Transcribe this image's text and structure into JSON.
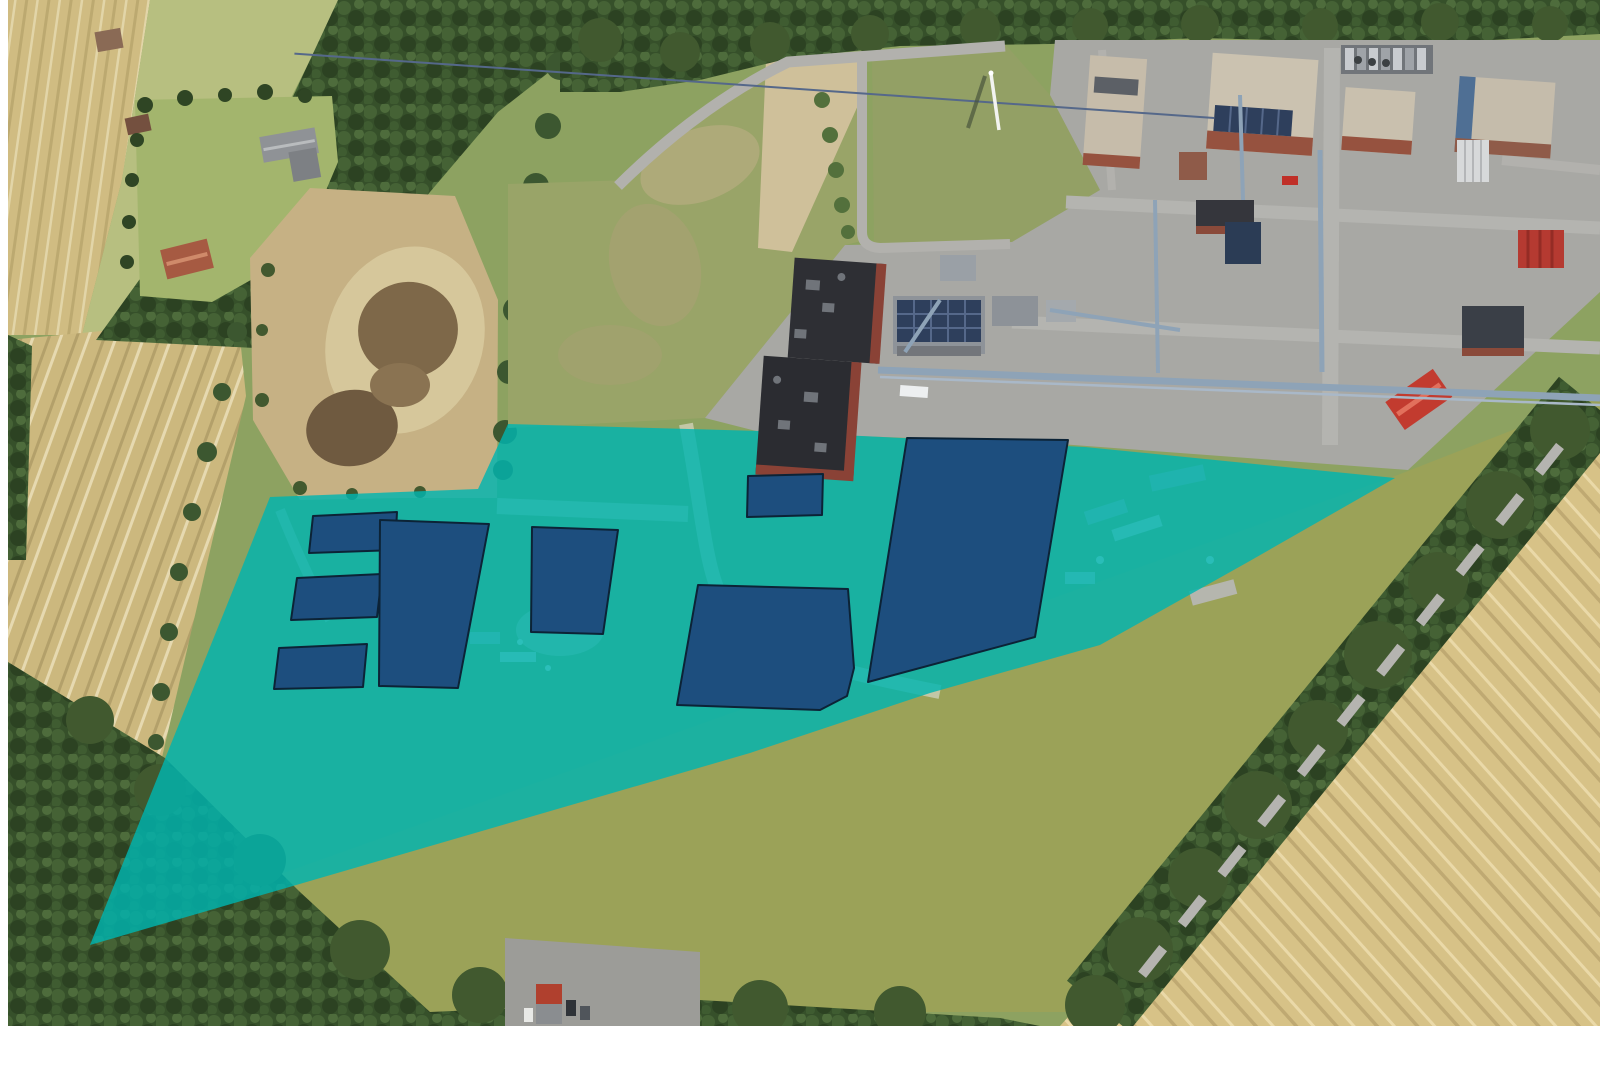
{
  "image": {
    "width": 1600,
    "height": 1066,
    "kind": "aerial-site-plan-overlay",
    "description": "Aerial photograph of a natural-gas processing plant with surrounding farmland; a teal polygon highlights the planned expansion site south-west of the plant and dark blue polygons mark planned building footprints. No text labels are visible."
  },
  "overlay": {
    "site_area": {
      "name": "highlighted-site-area",
      "fill": "#00b4b0",
      "opacity": 0.82,
      "points": [
        [
          270,
          497
        ],
        [
          478,
          489
        ],
        [
          508,
          424
        ],
        [
          760,
          431
        ],
        [
          1085,
          447
        ],
        [
          1395,
          478
        ],
        [
          1248,
          562
        ],
        [
          1100,
          645
        ],
        [
          930,
          693
        ],
        [
          750,
          753
        ],
        [
          90,
          945
        ],
        [
          233,
          590
        ]
      ]
    },
    "building_footprints": {
      "name": "planned-building-footprints",
      "fill": "#1d4e7e",
      "stroke": "#0c2336",
      "stroke_width": 2,
      "polygons": [
        {
          "id": "footprint-1",
          "points": [
            [
              313,
              516
            ],
            [
              397,
              512
            ],
            [
              395,
              550
            ],
            [
              309,
              553
            ]
          ]
        },
        {
          "id": "footprint-2",
          "points": [
            [
              297,
              578
            ],
            [
              382,
              574
            ],
            [
              377,
              617
            ],
            [
              291,
              620
            ]
          ]
        },
        {
          "id": "footprint-3",
          "points": [
            [
              279,
              648
            ],
            [
              367,
              644
            ],
            [
              363,
              687
            ],
            [
              274,
              689
            ]
          ]
        },
        {
          "id": "footprint-4",
          "points": [
            [
              380,
              520
            ],
            [
              489,
              524
            ],
            [
              458,
              688
            ],
            [
              379,
              686
            ]
          ]
        },
        {
          "id": "footprint-5",
          "points": [
            [
              532,
              527
            ],
            [
              618,
              530
            ],
            [
              603,
              634
            ],
            [
              531,
              632
            ]
          ]
        },
        {
          "id": "footprint-6",
          "points": [
            [
              748,
              476
            ],
            [
              823,
              474
            ],
            [
              822,
              515
            ],
            [
              747,
              517
            ]
          ]
        },
        {
          "id": "footprint-7",
          "points": [
            [
              907,
              438
            ],
            [
              1068,
              440
            ],
            [
              1035,
              637
            ],
            [
              868,
              682
            ]
          ]
        },
        {
          "id": "footprint-8",
          "points": [
            [
              698,
              585
            ],
            [
              848,
              589
            ],
            [
              854,
              668
            ],
            [
              847,
              696
            ],
            [
              820,
              710
            ],
            [
              677,
              705
            ]
          ]
        }
      ]
    }
  },
  "palette": {
    "margin": "#ffffff",
    "grass": "#8da261",
    "pasture": "#b7bf80",
    "clearing": "#a3b56d",
    "rough_field": "#99a468",
    "verge": "#9ba258",
    "wheat_left": "#ccb87e",
    "wheat_top_left": "#d0bc82",
    "wheat_right": "#d7c287",
    "forest": "#36502a",
    "dirt_field": "#c6b184",
    "pond_mud": "#6f5a40",
    "pavement": "#a8a8a4",
    "road": "#b2b1ad",
    "roof_tan": "#c9c0ae",
    "brick": "#96523f",
    "roof_dark": "#2e2f34",
    "pipe_rack": "#8ea3b7",
    "red_container": "#b53a31",
    "overlay_teal": "#00b4b0",
    "footprint_blue": "#1d4e7e"
  },
  "visible_features": [
    "gas processing plant with pipe racks and flare stack",
    "teal highlighted development area",
    "eight dark blue planned building footprints",
    "wheat fields with tramlines",
    "forest belts and tree rows",
    "dried pond in fallow field",
    "farmstead with red and grey roofed houses",
    "access roads and paved plant yard"
  ]
}
